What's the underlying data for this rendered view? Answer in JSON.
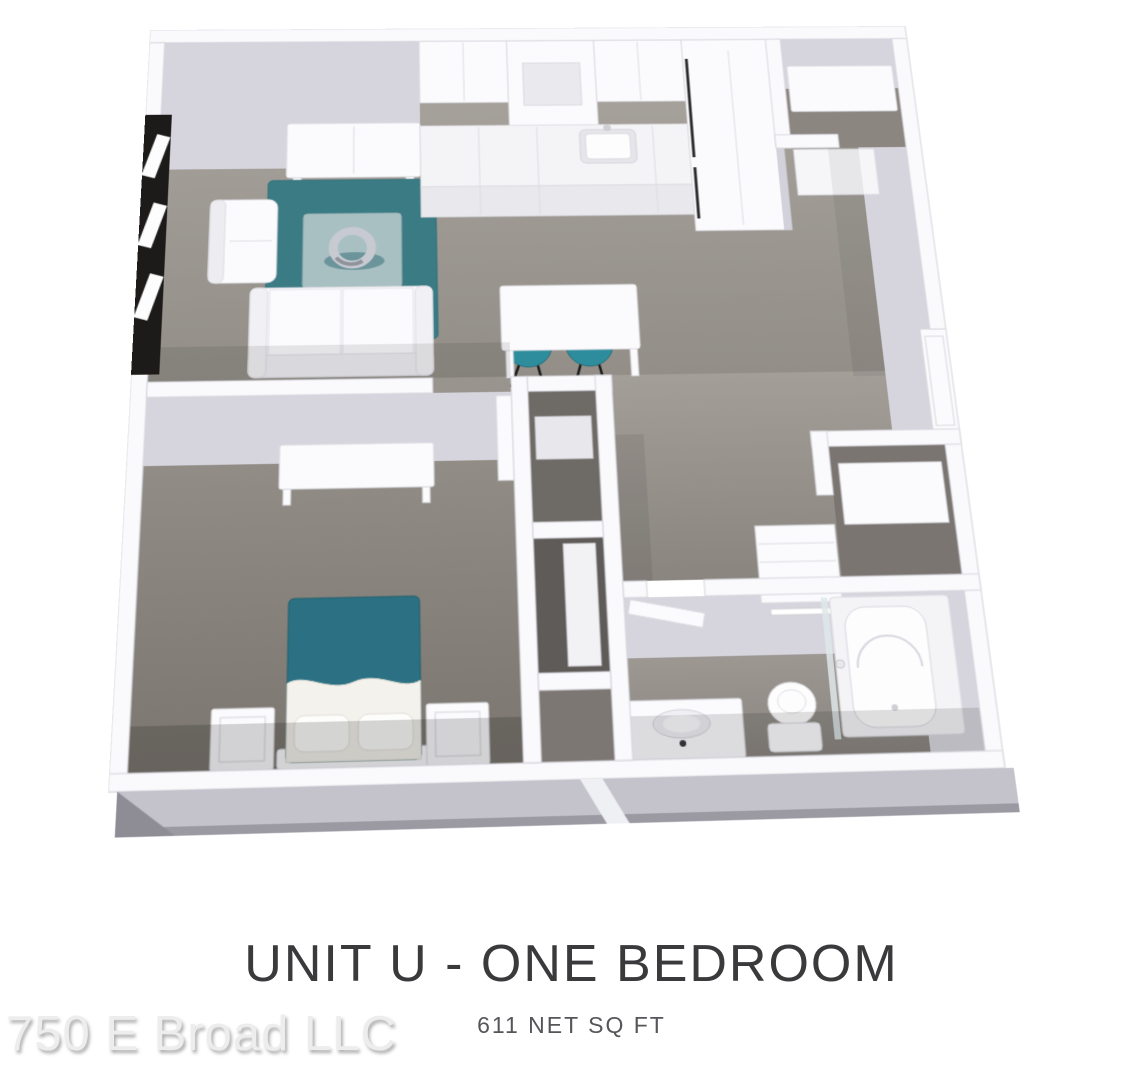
{
  "heading": {
    "title": "UNIT U - ONE BEDROOM",
    "subtitle": "611 NET SQ FT"
  },
  "watermark": {
    "text": "750 E Broad LLC"
  },
  "floorplan": {
    "view": "3d-isometric-render",
    "unit_name": "Unit U",
    "rooms": [
      "living-room",
      "kitchen",
      "dining-area",
      "bedroom",
      "bathroom",
      "entry-vestibule",
      "entry-closet",
      "hall-closets",
      "bath-closet"
    ],
    "furniture": [
      "window",
      "tv-console",
      "area-rug",
      "coffee-table",
      "sculpture",
      "armchair",
      "sofa",
      "upper-cabinets",
      "range-hood",
      "kitchen-counter",
      "kitchen-sink",
      "refrigerator",
      "dining-table",
      "dining-chairs",
      "closet-shelves",
      "desk",
      "bed",
      "nightstands",
      "linen-shelves",
      "towel-bar",
      "bathtub",
      "shower-glass",
      "toilet",
      "vanity-sink",
      "doors"
    ],
    "colors": {
      "accent_teal": "#2E7D8C",
      "rug_teal": "#3A7B84",
      "chair_teal": "#2E8D9C",
      "bed_teal": "#2B7183",
      "carpet": "#A6A09A",
      "carpet_dark": "#8F8A84",
      "wall_top": "#FAFAFC",
      "wall_edge": "#D6D5DD",
      "wall_face": "#D6D5DD",
      "wall_face_dark": "#C6C5CE",
      "window_frame": "#1D1B19",
      "slab": "#C4C3CB",
      "closet_shadow": "#6E6A66"
    }
  }
}
